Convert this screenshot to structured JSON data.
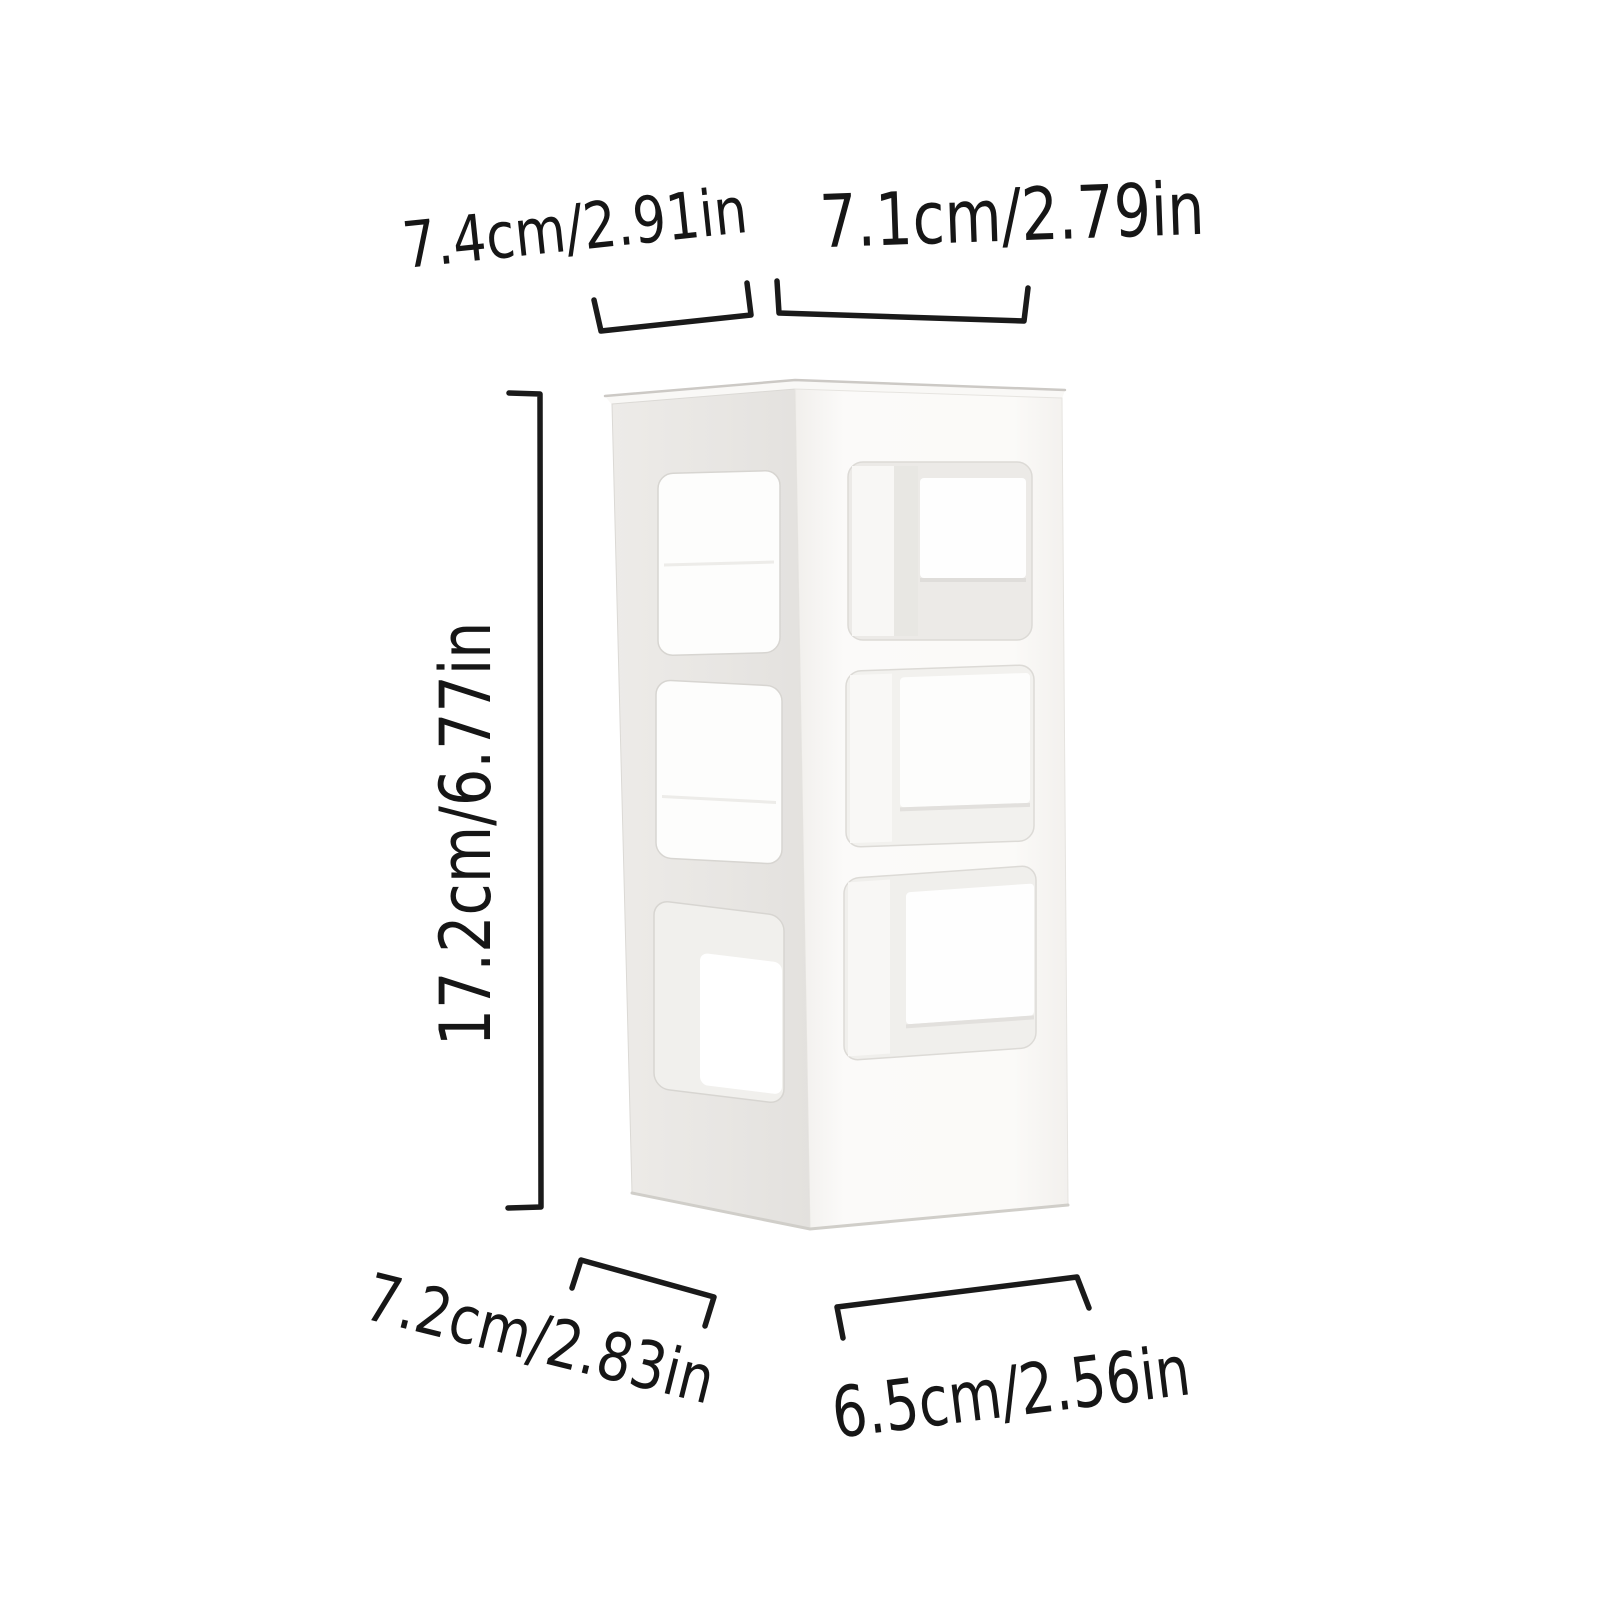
{
  "diagram": {
    "labels": {
      "top_width": "7.4cm/2.91in",
      "top_depth": "7.1cm/2.79in",
      "height": "17.2cm/6.77in",
      "bottom_width": "7.2cm/2.83in",
      "bottom_depth": "6.5cm/2.56in"
    },
    "colors": {
      "background": "#ffffff",
      "annotation": "#1a1a1a",
      "left_face": "#e9e7e4",
      "right_face": "#fbfaf9",
      "window_bright": "#fdfdfc",
      "edge_line": "#d6d4d0"
    },
    "product": {
      "name": "three-tier-white-storage-rack",
      "tiers": 3
    }
  }
}
